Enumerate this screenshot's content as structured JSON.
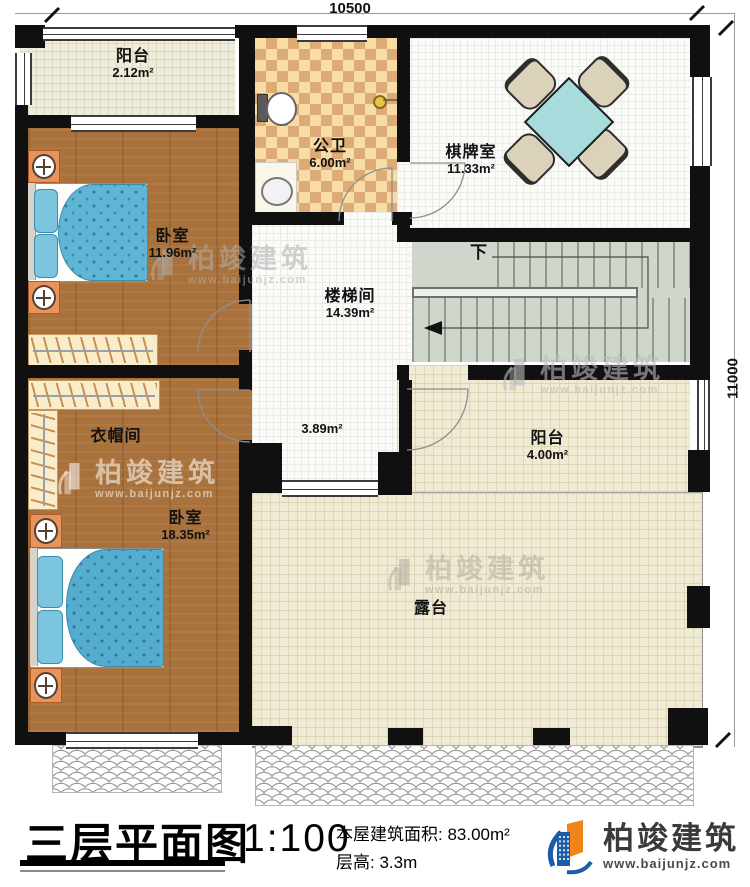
{
  "dimensions": {
    "top": "10500",
    "right": "11000"
  },
  "rooms": [
    {
      "name": "阳台",
      "area": "2.12m²"
    },
    {
      "name": "公卫",
      "area": "6.00m²"
    },
    {
      "name": "棋牌室",
      "area": "11.33m²"
    },
    {
      "name": "卧室",
      "area": "11.96m²"
    },
    {
      "name": "楼梯间",
      "area": "14.39m²"
    },
    {
      "name": "",
      "area": "3.89m²"
    },
    {
      "name": "衣帽间",
      "area": ""
    },
    {
      "name": "卧室",
      "area": "18.35m²"
    },
    {
      "name": "阳台",
      "area": "4.00m²"
    },
    {
      "name": "露台",
      "area": ""
    }
  ],
  "annotations": {
    "stairs_down": "下"
  },
  "title_block": {
    "title": "三层平面图",
    "scale": "1:100",
    "area_line": "本屋建筑面积: 83.00m²",
    "height_line": "层高: 3.3m"
  },
  "brand": {
    "name": "柏竣建筑",
    "url": "www.baijunjz.com"
  }
}
